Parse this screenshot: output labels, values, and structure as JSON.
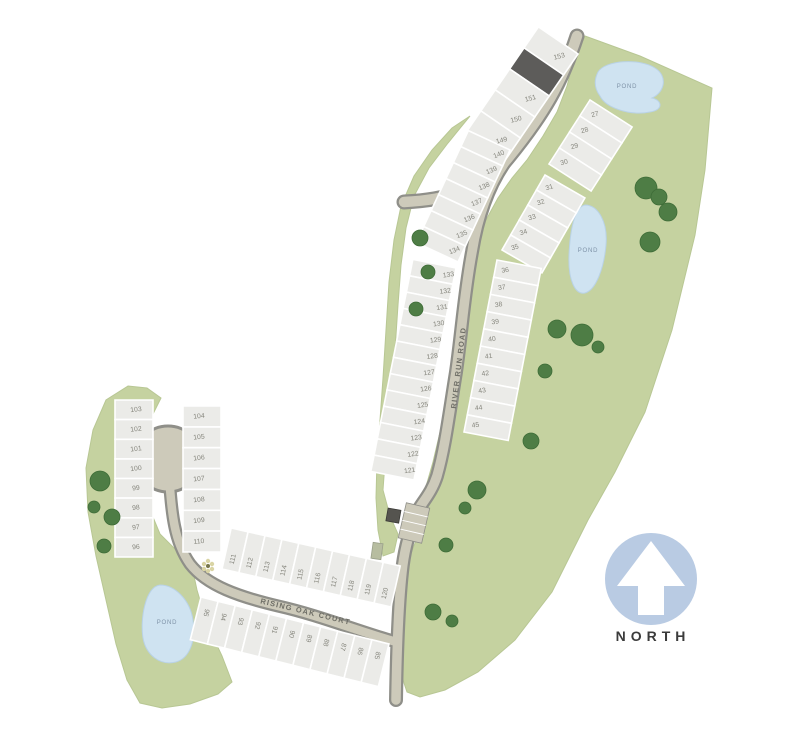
{
  "map": {
    "north_label": "NORTH",
    "road_labels": {
      "river_run": "RIVER RUN ROAD",
      "rising_oak": "RISING OAK COURT"
    },
    "pond_labels": [
      "POND",
      "POND",
      "POND"
    ],
    "lot_strips": [
      {
        "name": "north-row-west",
        "lots": [
          "153",
          "",
          "151",
          "150",
          "149"
        ]
      },
      {
        "name": "north-row-east",
        "lots": [
          "27",
          "28",
          "29",
          "30"
        ]
      },
      {
        "name": "east-upper",
        "lots": [
          "31",
          "32",
          "33",
          "34",
          "35"
        ]
      },
      {
        "name": "east-lower",
        "lots": [
          "36",
          "37",
          "38",
          "39",
          "40",
          "41",
          "42",
          "43",
          "44",
          "45"
        ]
      },
      {
        "name": "west-upper",
        "lots": [
          "140",
          "139",
          "138",
          "137",
          "136",
          "135",
          "134"
        ]
      },
      {
        "name": "west-lower",
        "lots": [
          "133",
          "132",
          "131",
          "130",
          "129",
          "128",
          "127",
          "126",
          "125",
          "124",
          "123",
          "122",
          "121"
        ]
      },
      {
        "name": "culdesac-west",
        "lots": [
          "103",
          "102",
          "101",
          "100",
          "99",
          "98",
          "97",
          "96"
        ]
      },
      {
        "name": "culdesac-east",
        "lots": [
          "104",
          "105",
          "106",
          "107",
          "108",
          "109",
          "110"
        ]
      },
      {
        "name": "court-north",
        "lots": [
          "111",
          "112",
          "113",
          "114",
          "115",
          "116",
          "117",
          "118",
          "119",
          "120"
        ]
      },
      {
        "name": "court-south",
        "lots": [
          "95",
          "94",
          "93",
          "92",
          "91",
          "90",
          "89",
          "88",
          "87",
          "86",
          "85"
        ]
      }
    ],
    "colors": {
      "green": "#c5d2a0",
      "pond": "#cfe3f1",
      "road": "#cdcaba",
      "road_edge": "#8f8f89",
      "lot": "#ebebe8",
      "lot_dark": "#5d5c5a",
      "lot_number": "#85857c",
      "north_circle": "#b9cbe3",
      "north_text": "#3b3b3b",
      "tree": "#4e7d45"
    }
  }
}
